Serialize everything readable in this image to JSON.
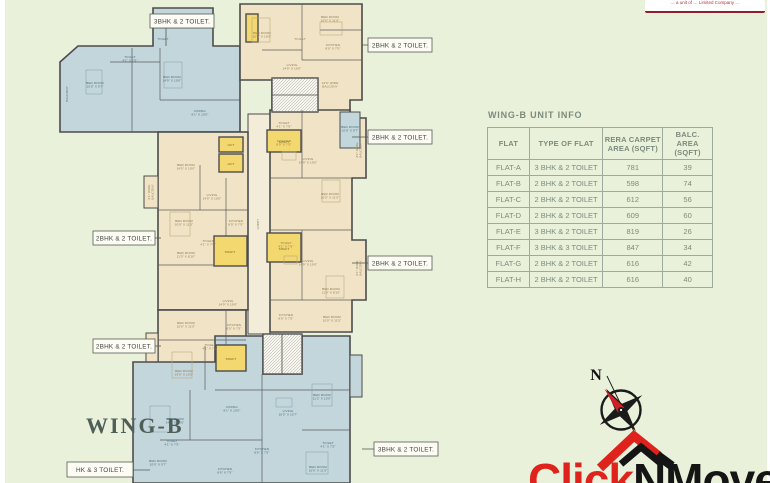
{
  "palette": {
    "background": "#eaf1da",
    "blue_room": "#c2d6dc",
    "cream_room": "#f1e3c6",
    "shaft_yellow": "#f3d76f",
    "wall": "#4c4c4c",
    "table_gray_green": "#7c8b7d",
    "brand_red": "#df221c",
    "brand_black": "#151515"
  },
  "disclaimer": {
    "text": "… a unit of … Limited Company …"
  },
  "plan": {
    "wing_label": "WING-B",
    "callouts": [
      {
        "label": "3BHK & 2 TOILET."
      },
      {
        "label": "2BHK & 2 TOILET."
      },
      {
        "label": "2BHK & 2 TOILET."
      },
      {
        "label": "2BHK & 2 TOILET."
      },
      {
        "label": "2BHK & 2 TOILET."
      },
      {
        "label": "2BHK & 2 TOILET."
      },
      {
        "label": "3BHK & 2 TOILET."
      },
      {
        "label": "HK & 3 TOILET."
      }
    ],
    "rooms": [
      {
        "t": [
          "BED ROOM",
          "10'0\" X 9'7\""
        ],
        "x": 95,
        "y": 84,
        "c": "b"
      },
      {
        "t": [
          "TOILET",
          "4'1\" X 7'5\""
        ],
        "x": 130,
        "y": 58,
        "c": "b"
      },
      {
        "t": [
          "BED ROOM",
          "14'9\" X 10'0\""
        ],
        "x": 172,
        "y": 78,
        "c": "b"
      },
      {
        "t": [
          "BED ROOM",
          "10'4\" X 10'0\""
        ],
        "x": 183,
        "y": 20,
        "c": "b"
      },
      {
        "t": [
          "TOILET"
        ],
        "x": 163,
        "y": 40,
        "c": "b"
      },
      {
        "t": [
          "DINING",
          "8'1\" X 10'0\""
        ],
        "x": 200,
        "y": 112,
        "c": "b"
      },
      {
        "t": [
          "BALCONY"
        ],
        "x": 68,
        "y": 94,
        "c": "b",
        "r": -90
      },
      {
        "t": [
          "BED ROOM",
          "10'4\" X 10'0\""
        ],
        "x": 262,
        "y": 34,
        "c": "c"
      },
      {
        "t": [
          "BED ROOM",
          "10'0\" X 11'6\""
        ],
        "x": 330,
        "y": 18,
        "c": "c"
      },
      {
        "t": [
          "KITCHEN",
          "8'0\" X 7'5\""
        ],
        "x": 333,
        "y": 46,
        "c": "c"
      },
      {
        "t": [
          "LIVING",
          "14'9\" X 10'0\""
        ],
        "x": 292,
        "y": 66,
        "c": "c"
      },
      {
        "t": [
          "14'9\" WIDE",
          "BALCONY"
        ],
        "x": 330,
        "y": 84,
        "c": "c"
      },
      {
        "t": [
          "TOILET"
        ],
        "x": 300,
        "y": 40,
        "c": "c"
      },
      {
        "t": [
          "TOILET",
          "4'1\" X 7'5\""
        ],
        "x": 284,
        "y": 124,
        "c": "c"
      },
      {
        "t": [
          "KITCHEN",
          "8'0\" X 7'5\""
        ],
        "x": 284,
        "y": 142,
        "c": "c"
      },
      {
        "t": [
          "LIVING",
          "14'9\" X 10'0\""
        ],
        "x": 308,
        "y": 160,
        "c": "c"
      },
      {
        "t": [
          "BED ROOM",
          "10'0\" X 11'5\""
        ],
        "x": 330,
        "y": 195,
        "c": "c"
      },
      {
        "t": [
          "BED ROOM",
          "10'0\" X 9'7\""
        ],
        "x": 350,
        "y": 128,
        "c": "b"
      },
      {
        "t": [
          "6'1\" WIDE",
          "BALCONY"
        ],
        "x": 358,
        "y": 150,
        "c": "c",
        "r": -90
      },
      {
        "t": [
          "TOILET",
          "4'1\" X 7'5\""
        ],
        "x": 286,
        "y": 244,
        "c": "c"
      },
      {
        "t": [
          "LIVING",
          "14'9\" X 10'0\""
        ],
        "x": 308,
        "y": 262,
        "c": "c"
      },
      {
        "t": [
          "BED ROOM",
          "11'0\" X 8'10\""
        ],
        "x": 331,
        "y": 290,
        "c": "c"
      },
      {
        "t": [
          "KITCHEN",
          "8'0\" X 7'5\""
        ],
        "x": 286,
        "y": 316,
        "c": "c"
      },
      {
        "t": [
          "BED ROOM",
          "10'0\" X 11'5\""
        ],
        "x": 332,
        "y": 318,
        "c": "c"
      },
      {
        "t": [
          "6'1\" WIDE",
          "BALCONY"
        ],
        "x": 358,
        "y": 268,
        "c": "c",
        "r": -90
      },
      {
        "t": [
          "LIVING",
          "14'9\" X 10'0\""
        ],
        "x": 212,
        "y": 196,
        "c": "c"
      },
      {
        "t": [
          "BED ROOM",
          "10'0\" X 11'5\""
        ],
        "x": 184,
        "y": 222,
        "c": "c"
      },
      {
        "t": [
          "BED ROOM",
          "11'0\" X 8'10\""
        ],
        "x": 186,
        "y": 254,
        "c": "c"
      },
      {
        "t": [
          "KITCHEN",
          "8'0\" X 7'5\""
        ],
        "x": 236,
        "y": 222,
        "c": "c"
      },
      {
        "t": [
          "TOILET",
          "4'1\" X 7'5\""
        ],
        "x": 208,
        "y": 242,
        "c": "c"
      },
      {
        "t": [
          "BED ROOM",
          "14'0\" X 10'0\""
        ],
        "x": 186,
        "y": 166,
        "c": "c"
      },
      {
        "t": [
          "6'1\" WIDE",
          "BALCONY"
        ],
        "x": 150,
        "y": 192,
        "c": "c",
        "r": -90
      },
      {
        "t": [
          "LIVING",
          "14'9\" X 10'0\""
        ],
        "x": 228,
        "y": 302,
        "c": "c"
      },
      {
        "t": [
          "BED ROOM",
          "10'0\" X 11'5\""
        ],
        "x": 186,
        "y": 324,
        "c": "c"
      },
      {
        "t": [
          "KITCHEN",
          "8'0\" X 7'5\""
        ],
        "x": 234,
        "y": 326,
        "c": "c"
      },
      {
        "t": [
          "TOILET",
          "4'1\" X 7'5\""
        ],
        "x": 210,
        "y": 346,
        "c": "c"
      },
      {
        "t": [
          "BED ROOM",
          "14'0\" X 10'0\""
        ],
        "x": 184,
        "y": 372,
        "c": "c"
      },
      {
        "t": [
          "BED ROOM",
          "14'0\" X 10'0\""
        ],
        "x": 175,
        "y": 420,
        "c": "b"
      },
      {
        "t": [
          "BED ROOM",
          "10'0\" X 9'7\""
        ],
        "x": 158,
        "y": 462,
        "c": "b"
      },
      {
        "t": [
          "TOILET",
          "4'1\" X 7'5\""
        ],
        "x": 172,
        "y": 442,
        "c": "b"
      },
      {
        "t": [
          "DINING",
          "8'1\" X 10'0\""
        ],
        "x": 232,
        "y": 408,
        "c": "b"
      },
      {
        "t": [
          "LIVING",
          "16'0\" X 10'7\""
        ],
        "x": 288,
        "y": 412,
        "c": "b"
      },
      {
        "t": [
          "KITCHEN",
          "8'6\" X 7'5\""
        ],
        "x": 262,
        "y": 450,
        "c": "b"
      },
      {
        "t": [
          "KITCHEN",
          "8'6\" X 7'5\""
        ],
        "x": 225,
        "y": 470,
        "c": "b"
      },
      {
        "t": [
          "BED ROOM",
          "11'2\" X 10'0\""
        ],
        "x": 322,
        "y": 396,
        "c": "b"
      },
      {
        "t": [
          "TOILET",
          "4'1\" X 7'5\""
        ],
        "x": 328,
        "y": 444,
        "c": "b"
      },
      {
        "t": [
          "BED ROOM",
          "10'0\" X 11'5\""
        ],
        "x": 318,
        "y": 468,
        "c": "b"
      },
      {
        "t": [
          "LIFT"
        ],
        "x": 231,
        "y": 146,
        "c": "y"
      },
      {
        "t": [
          "LIFT"
        ],
        "x": 231,
        "y": 165,
        "c": "y"
      },
      {
        "t": [
          "SHAFT"
        ],
        "x": 284,
        "y": 143,
        "c": "y"
      },
      {
        "t": [
          "SHAFT"
        ],
        "x": 230,
        "y": 253,
        "c": "y"
      },
      {
        "t": [
          "SHAFT"
        ],
        "x": 284,
        "y": 250,
        "c": "y"
      },
      {
        "t": [
          "SHAFT"
        ],
        "x": 231,
        "y": 360,
        "c": "y"
      },
      {
        "t": [
          "LOBBY"
        ],
        "x": 259,
        "y": 224,
        "c": "c",
        "r": -90
      }
    ]
  },
  "unit_table": {
    "title": "WING-B UNIT INFO",
    "columns": [
      "FLAT",
      "TYPE OF FLAT",
      "RERA CARPET\nAREA (SQFT)",
      "BALC. AREA\n(SQFT)"
    ],
    "rows": [
      [
        "FLAT-A",
        "3 BHK & 2 TOILET",
        "781",
        "39"
      ],
      [
        "FLAT-B",
        "2 BHK & 2 TOILET",
        "598",
        "74"
      ],
      [
        "FLAT-C",
        "2 BHK & 2 TOILET",
        "612",
        "56"
      ],
      [
        "FLAT-D",
        "2 BHK & 2 TOILET",
        "609",
        "60"
      ],
      [
        "FLAT-E",
        "3 BHK & 2 TOILET",
        "819",
        "26"
      ],
      [
        "FLAT-F",
        "3 BHK & 3 TOILET",
        "847",
        "34"
      ],
      [
        "FLAT-G",
        "2 BHK & 2 TOILET",
        "616",
        "42"
      ],
      [
        "FLAT-H",
        "2 BHK & 2 TOILET",
        "616",
        "40"
      ]
    ]
  },
  "compass": {
    "north_label": "N"
  },
  "logo": {
    "part1": "Click",
    "part2": "NMove"
  }
}
